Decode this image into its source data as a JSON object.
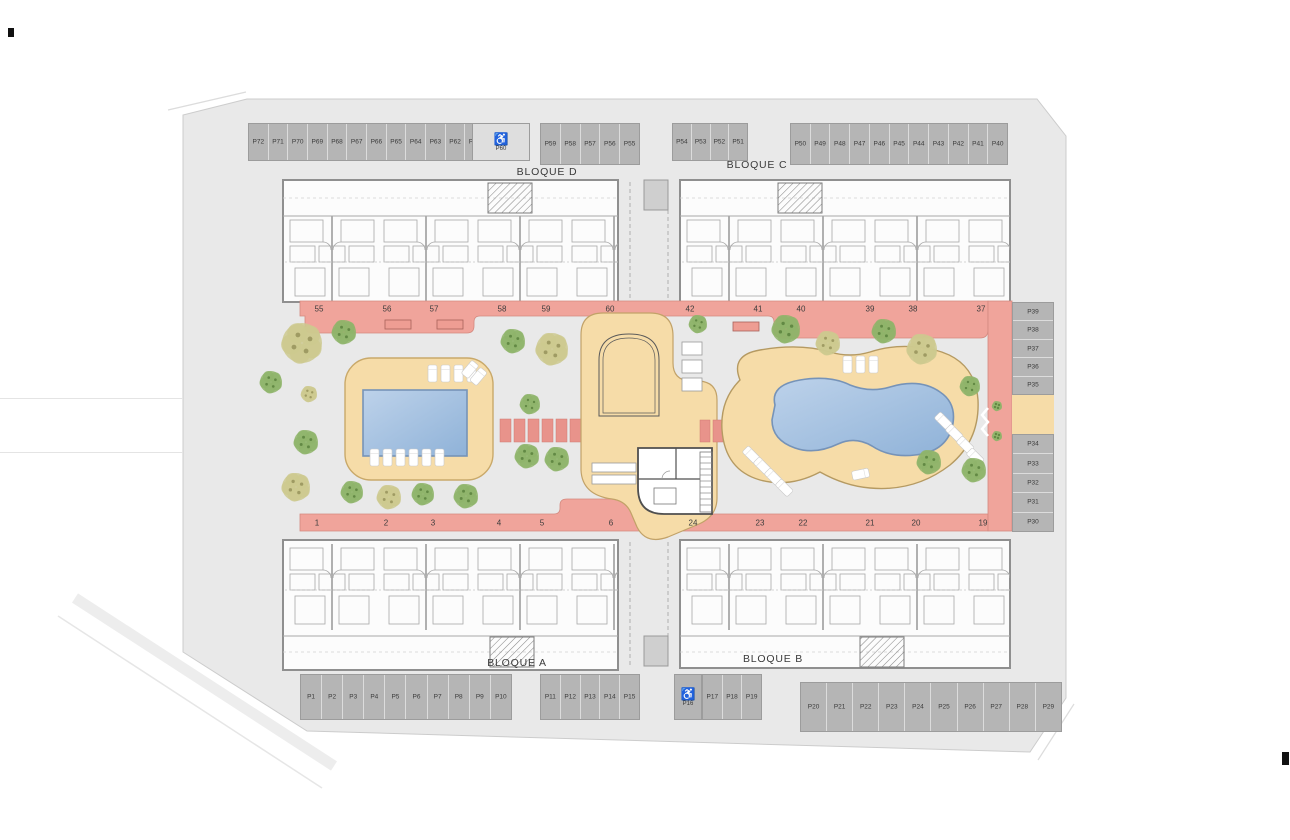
{
  "colors": {
    "site_bg": "#e9e9e9",
    "boundary": "#cccccc",
    "wall": "#8f8f8f",
    "walkway": "#f0a49b",
    "walkway_edge": "#d4897f",
    "pad": "#e8938b",
    "deck": "#f6dca8",
    "deck_edge": "#c9a96a",
    "pool_light": "#bdd2ea",
    "pool_dark": "#8fb2d8",
    "pool_edge": "#7693b8",
    "stall": "#b5b5b5",
    "stall_divider": "#dcdcdc",
    "stall_border": "#9c9c9c",
    "stall_text": "#3b3b3b",
    "tree_olive": "#cdc98f",
    "tree_olive_dark": "#9a965e",
    "tree_green": "#8fb46a",
    "tree_green_dark": "#5d8440"
  },
  "blocks": [
    {
      "label": "BLOQUE D",
      "x": 547,
      "y": 172
    },
    {
      "label": "BLOQUE C",
      "x": 757,
      "y": 165
    },
    {
      "label": "BLOQUE A",
      "x": 517,
      "y": 663
    },
    {
      "label": "BLOQUE B",
      "x": 773,
      "y": 659
    }
  ],
  "parking": {
    "accessible_icon": "♿",
    "groups": [
      {
        "name": "top-left",
        "x": 248,
        "y": 123,
        "w": 237,
        "h": 38,
        "dir": "h",
        "labels": [
          "P72",
          "P71",
          "P70",
          "P69",
          "P68",
          "P67",
          "P66",
          "P65",
          "P64",
          "P63",
          "P62",
          "P61"
        ]
      },
      {
        "name": "top-accessible",
        "x": 472,
        "y": 123,
        "w": 58,
        "h": 38,
        "dir": "h",
        "accessible": true,
        "bg": "#dedede",
        "labels": [
          "P60"
        ]
      },
      {
        "name": "top-middle",
        "x": 540,
        "y": 123,
        "w": 100,
        "h": 42,
        "dir": "h",
        "labels": [
          "P59",
          "P58",
          "P57",
          "P56",
          "P55"
        ]
      },
      {
        "name": "top-right-a",
        "x": 672,
        "y": 123,
        "w": 76,
        "h": 38,
        "dir": "h",
        "labels": [
          "P54",
          "P53",
          "P52",
          "P51"
        ]
      },
      {
        "name": "top-right-b",
        "x": 790,
        "y": 123,
        "w": 218,
        "h": 42,
        "dir": "h",
        "labels": [
          "P50",
          "P49",
          "P48",
          "P47",
          "P46",
          "P45",
          "P44",
          "P43",
          "P42",
          "P41",
          "P40"
        ]
      },
      {
        "name": "right-upper",
        "x": 1012,
        "y": 302,
        "w": 42,
        "h": 93,
        "dir": "v",
        "labels": [
          "P39",
          "P38",
          "P37",
          "P36",
          "P35"
        ]
      },
      {
        "name": "right-lower",
        "x": 1012,
        "y": 434,
        "w": 42,
        "h": 98,
        "dir": "v",
        "labels": [
          "P34",
          "P33",
          "P32",
          "P31",
          "P30"
        ]
      },
      {
        "name": "bottom-left",
        "x": 300,
        "y": 674,
        "w": 212,
        "h": 46,
        "dir": "h",
        "labels": [
          "P1",
          "P2",
          "P3",
          "P4",
          "P5",
          "P6",
          "P7",
          "P8",
          "P9",
          "P10"
        ]
      },
      {
        "name": "bottom-middle-a",
        "x": 540,
        "y": 674,
        "w": 100,
        "h": 46,
        "dir": "h",
        "labels": [
          "P11",
          "P12",
          "P13",
          "P14",
          "P15"
        ]
      },
      {
        "name": "bottom-accessible",
        "x": 674,
        "y": 674,
        "w": 28,
        "h": 46,
        "dir": "h",
        "accessible": true,
        "labels": [
          "P16"
        ]
      },
      {
        "name": "bottom-middle-b",
        "x": 702,
        "y": 674,
        "w": 60,
        "h": 46,
        "dir": "h",
        "labels": [
          "P17",
          "P18",
          "P19"
        ]
      },
      {
        "name": "bottom-right",
        "x": 800,
        "y": 682,
        "w": 262,
        "h": 50,
        "dir": "h",
        "labels": [
          "P20",
          "P21",
          "P22",
          "P23",
          "P24",
          "P25",
          "P26",
          "P27",
          "P28",
          "P29"
        ]
      }
    ]
  },
  "unit_numbers": {
    "top": {
      "y": 309,
      "items": [
        [
          "55",
          319
        ],
        [
          "56",
          387
        ],
        [
          "57",
          434
        ],
        [
          "58",
          502
        ],
        [
          "59",
          546
        ],
        [
          "60",
          610
        ],
        [
          "42",
          690
        ],
        [
          "41",
          758
        ],
        [
          "40",
          801
        ],
        [
          "39",
          870
        ],
        [
          "38",
          913
        ],
        [
          "37",
          981
        ]
      ]
    },
    "bottom": {
      "y": 523,
      "items": [
        [
          "1",
          317
        ],
        [
          "2",
          386
        ],
        [
          "3",
          433
        ],
        [
          "4",
          499
        ],
        [
          "5",
          542
        ],
        [
          "6",
          611
        ],
        [
          "24",
          693
        ],
        [
          "23",
          760
        ],
        [
          "22",
          803
        ],
        [
          "21",
          870
        ],
        [
          "20",
          916
        ],
        [
          "19",
          983
        ]
      ]
    }
  },
  "landscape": {
    "trees": [
      [
        302,
        343,
        20,
        "olive"
      ],
      [
        344,
        332,
        12,
        "green"
      ],
      [
        271,
        382,
        11,
        "green"
      ],
      [
        309,
        394,
        8,
        "olive"
      ],
      [
        306,
        442,
        12,
        "green"
      ],
      [
        296,
        487,
        14,
        "olive"
      ],
      [
        352,
        492,
        11,
        "green"
      ],
      [
        389,
        497,
        12,
        "olive"
      ],
      [
        423,
        494,
        11,
        "green"
      ],
      [
        466,
        496,
        12,
        "green"
      ],
      [
        513,
        341,
        12,
        "green"
      ],
      [
        552,
        349,
        16,
        "olive"
      ],
      [
        530,
        404,
        10,
        "green"
      ],
      [
        527,
        456,
        12,
        "green"
      ],
      [
        557,
        459,
        12,
        "green"
      ],
      [
        698,
        324,
        9,
        "green"
      ],
      [
        786,
        329,
        14,
        "green"
      ],
      [
        828,
        343,
        12,
        "olive"
      ],
      [
        884,
        331,
        12,
        "green"
      ],
      [
        922,
        349,
        15,
        "olive"
      ],
      [
        970,
        386,
        10,
        "green"
      ],
      [
        929,
        462,
        12,
        "green"
      ],
      [
        974,
        470,
        12,
        "green"
      ],
      [
        997,
        406,
        5,
        "green"
      ],
      [
        997,
        436,
        5,
        "green"
      ]
    ]
  }
}
